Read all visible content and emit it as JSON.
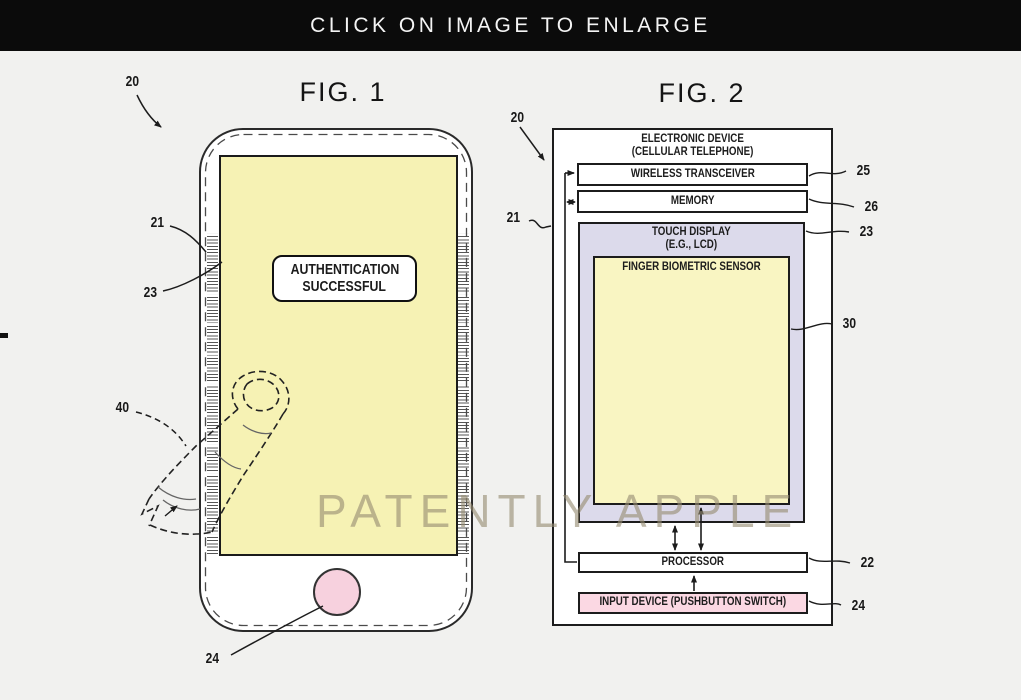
{
  "banner": {
    "label": "CLICK ON IMAGE TO ENLARGE"
  },
  "watermark": {
    "text": "PATENTLY APPLE"
  },
  "fig1": {
    "title": "FIG. 1",
    "screen_message": {
      "line1": "AUTHENTICATION",
      "line2": "SUCCESSFUL"
    },
    "refs": {
      "device": "20",
      "housing": "21",
      "display": "23",
      "finger": "40",
      "home_button": "24"
    }
  },
  "fig2": {
    "title": "FIG. 2",
    "device_title": {
      "line1": "ELECTRONIC DEVICE",
      "line2": "(CELLULAR TELEPHONE)"
    },
    "blocks": {
      "wireless_transceiver": "WIRELESS TRANSCEIVER",
      "memory": "MEMORY",
      "touch_display_line1": "TOUCH DISPLAY",
      "touch_display_line2": "(E.G., LCD)",
      "finger_biometric_sensor": "FINGER BIOMETRIC SENSOR",
      "processor": "PROCESSOR",
      "input_device": "INPUT DEVICE (PUSHBUTTON SWITCH)"
    },
    "refs": {
      "device": "20",
      "housing": "21",
      "wireless_transceiver": "25",
      "memory": "26",
      "touch_display": "23",
      "finger_biometric_sensor": "30",
      "processor": "22",
      "input_device": "24"
    }
  },
  "colors": {
    "banner_bg": "#0b0b0b",
    "background": "#f1f1ef",
    "screen_yellow": "#f6f2b4",
    "sensor_yellow": "#f9f5c2",
    "display_lavender": "#dcdaeb",
    "home_button_pink": "#f7d1de",
    "input_device_pink": "#fbd8e3",
    "line": "#1c1c1c",
    "watermark": "#96906f"
  }
}
